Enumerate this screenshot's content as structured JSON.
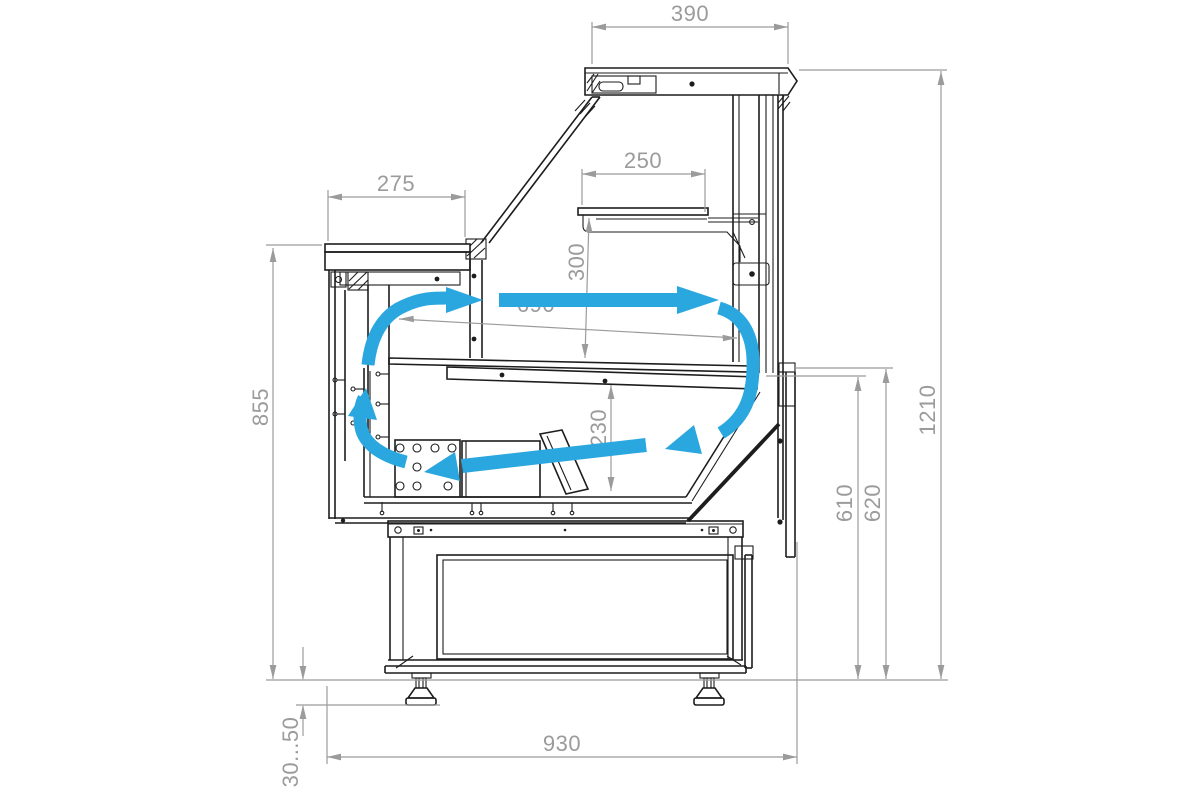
{
  "drawing": {
    "dimensions": {
      "canopy_width": "390",
      "worktop_depth": "275",
      "shelf_depth": "250",
      "shelf_clearance": "300",
      "deck_length": "690",
      "well_height": "230",
      "front_height": "855",
      "deck_rear_height": "610",
      "rear_edge_height": "620",
      "total_height": "1210",
      "base_depth": "930",
      "foot_adjust_range": "30...50"
    },
    "colors": {
      "outline": "#1d1d1d",
      "dimension": "#9b9b9b",
      "airflow": "#2AA7DF",
      "background": "#ffffff"
    }
  }
}
